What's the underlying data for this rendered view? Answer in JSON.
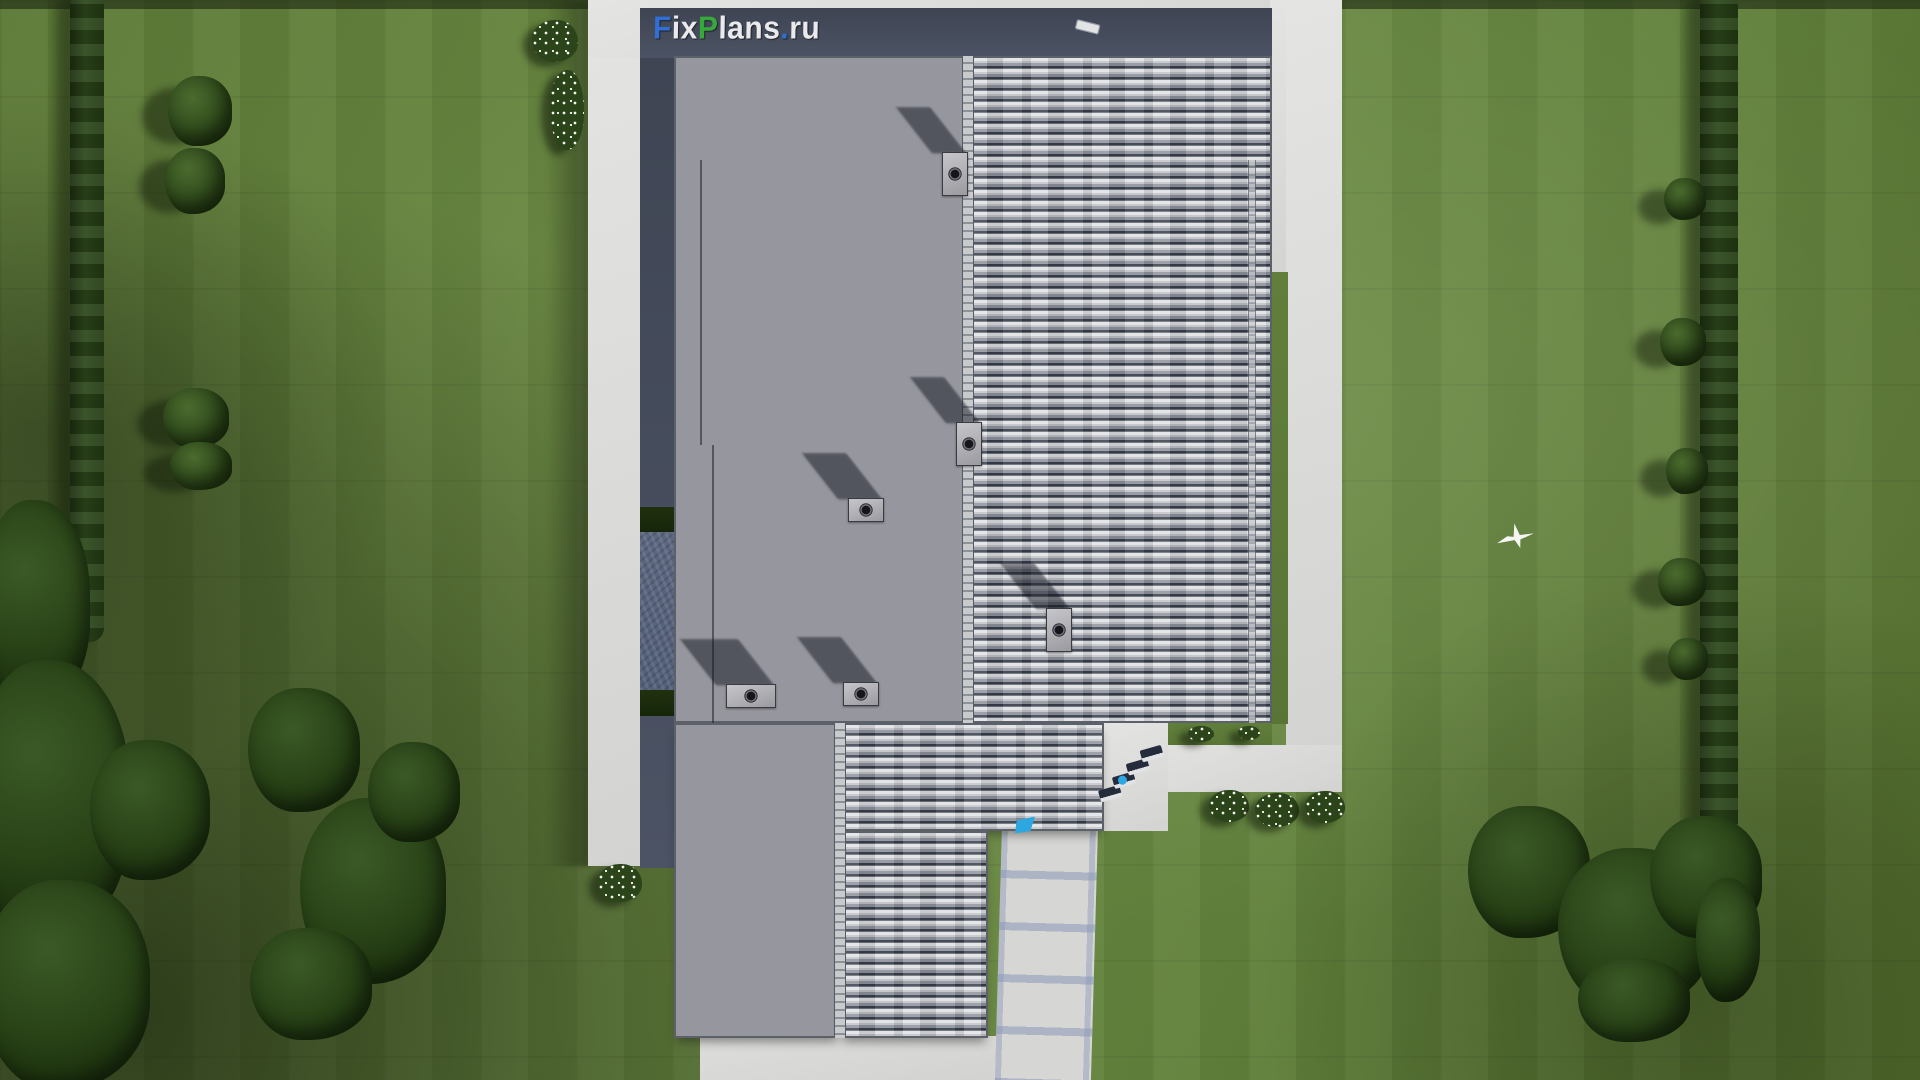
{
  "scene": {
    "kind": "aerial-roof-plan-render",
    "watermark": {
      "full_text": "FixPlans.ru",
      "segments": [
        {
          "text": "F",
          "color": "#2f6fd6"
        },
        {
          "text": "ix",
          "color": "#e9e9ee"
        },
        {
          "text": "P",
          "color": "#37a93c"
        },
        {
          "text": "lans",
          "color": "#e9e9ee"
        },
        {
          "text": ".",
          "color": "#2f6fd6"
        },
        {
          "text": "ru",
          "color": "#e9e9ee"
        }
      ]
    },
    "palette": {
      "lawn_green": "#63813c",
      "hedge_green": "#2c401d",
      "roof_shingle_gray": "#96969e",
      "roof_ribbed_light": "#c1c3c8",
      "roof_fascia_dark": "#5c6069",
      "parapet_wall": "#454c5c",
      "paving_white": "#dcdcda",
      "walkway_joint_blue": "#8a98b8",
      "pool_blue": "#2ea7e0",
      "lounger_white": "#e2e3e5",
      "lounger_navy": "#252c3c",
      "cushion_blue": "#2a6cd8"
    },
    "objects": {
      "roof_vent_stacks": 6,
      "sun_loungers_top_row": 5,
      "sun_loungers_terrace": 4,
      "flower_clusters": 8,
      "flying_bird": 1
    }
  }
}
